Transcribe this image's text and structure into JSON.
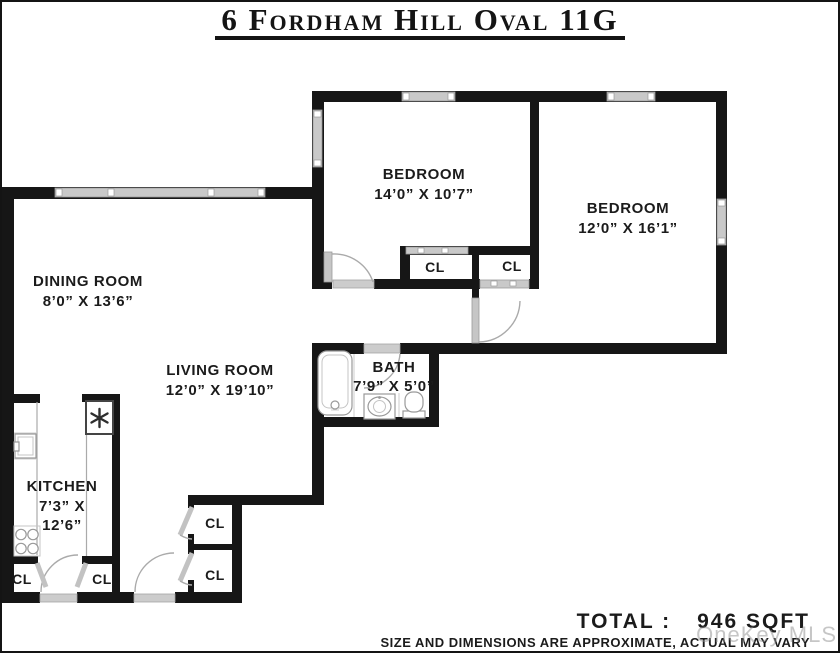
{
  "title": "6 Fordham Hill Oval 11G",
  "rooms": {
    "bedroom1": {
      "name": "BEDROOM",
      "dims": "14’0” X 10’7”"
    },
    "bedroom2": {
      "name": "BEDROOM",
      "dims": "12’0” X 16’1”"
    },
    "dining": {
      "name": "DINING ROOM",
      "dims": "8’0” X 13’6”"
    },
    "living": {
      "name": "LIVING ROOM",
      "dims": "12’0” X 19’10”"
    },
    "bath": {
      "name": "BATH",
      "dims": "7’9” X 5’0”"
    },
    "kitchen": {
      "name": "KITCHEN",
      "dims_line1": "7’3” X",
      "dims_line2": "12’6”"
    }
  },
  "closet_label": "CL",
  "summary": {
    "total_label": "TOTAL :",
    "total_value": "946 SQFT",
    "disclaimer": "SIZE AND DIMENSIONS ARE APPROXIMATE, ACTUAL MAY VARY"
  },
  "watermark": "OneKey MLS",
  "colors": {
    "wall": "#161616",
    "window": "#c9c9c9",
    "door": "#c2c2c2",
    "text": "#1b1b1b"
  }
}
